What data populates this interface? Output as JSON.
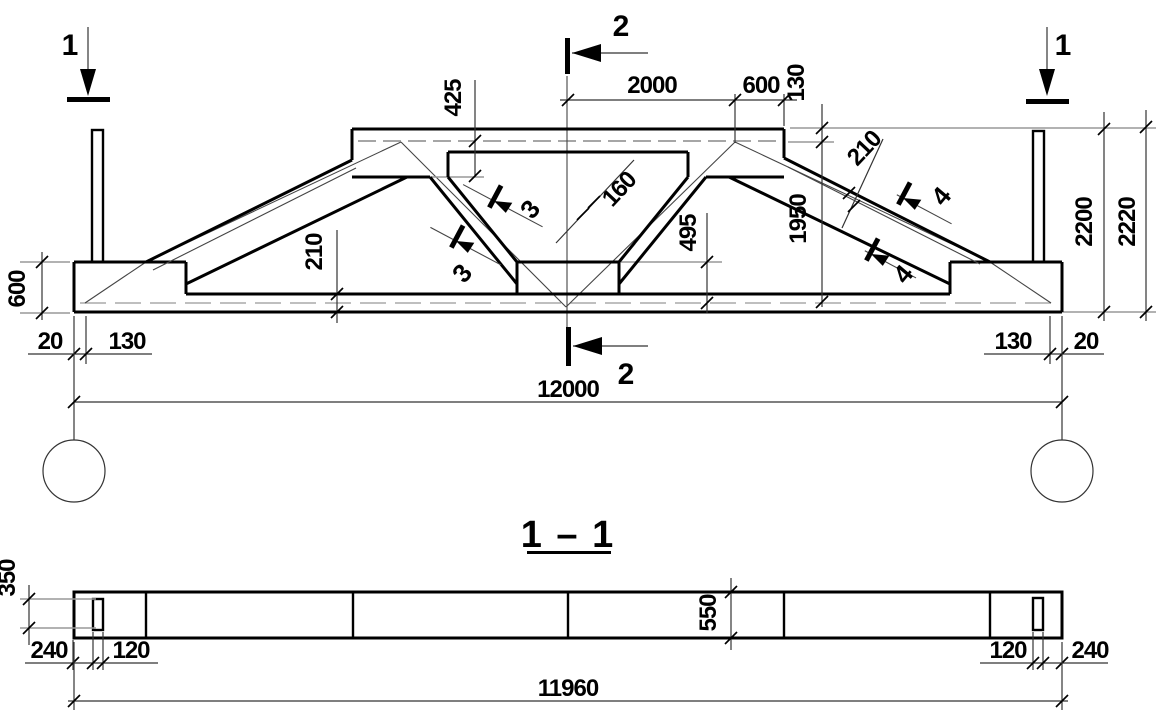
{
  "colors": {
    "line": "#000000",
    "dim_line": "#333333",
    "aux_line": "#999999",
    "background": "#ffffff"
  },
  "main_view": {
    "dims": {
      "top_2000": "2000",
      "top_600": "600",
      "top_130": "130",
      "left_425": "425",
      "diag_160": "160",
      "mid_495": "495",
      "right_1950": "1950",
      "slope_210": "210",
      "chord_210": "210",
      "left_600": "600",
      "bottom_left_20": "20",
      "bottom_left_130": "130",
      "bottom_right_130": "130",
      "bottom_right_20": "20",
      "span_12000": "12000",
      "height_2200": "2200",
      "height_2220": "2220"
    },
    "section_marker_1": "1",
    "section_marker_2": "2",
    "weld_mark_3": "3",
    "weld_mark_4": "4"
  },
  "section_view": {
    "title": "1 – 1",
    "dims": {
      "left_350": "350",
      "bottom_left_240": "240",
      "bottom_left_120": "120",
      "mid_550": "550",
      "bottom_right_120": "120",
      "bottom_right_240": "240",
      "span_11960": "11960"
    }
  }
}
